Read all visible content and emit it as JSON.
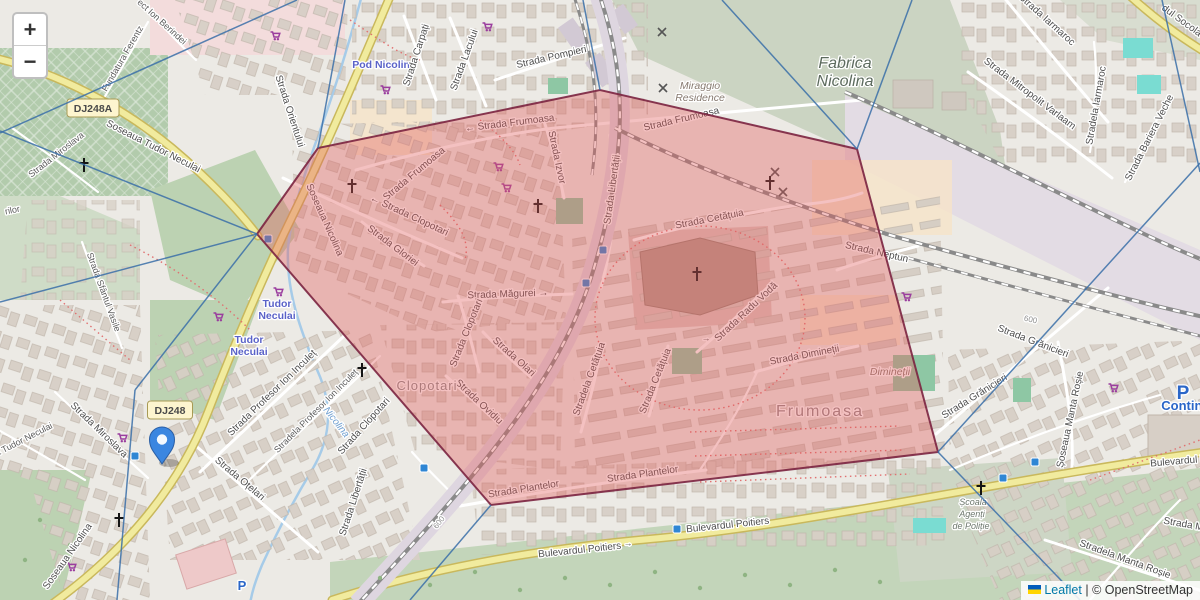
{
  "controls": {
    "zoom_in_label": "+",
    "zoom_out_label": "−"
  },
  "attribution": {
    "flag_icon": "ukraine-flag",
    "leaflet_text": "Leaflet",
    "separator": " | ",
    "copyright_text": "© OpenStreetMap"
  },
  "overlay": {
    "selected_region": {
      "fill": "#e35d5d",
      "fill_opacity": 0.38,
      "stroke": "#7b2440",
      "points": [
        [
          257,
          234
        ],
        [
          318,
          148
        ],
        [
          600,
          90
        ],
        [
          857,
          149
        ],
        [
          938,
          452
        ],
        [
          491,
          505
        ]
      ]
    },
    "boundary_lines": {
      "color": "#3a6ea8",
      "segments": [
        [
          297,
          0,
          0,
          133
        ],
        [
          0,
          131,
          257,
          234
        ],
        [
          257,
          234,
          0,
          302
        ],
        [
          257,
          234,
          135,
          390
        ],
        [
          135,
          390,
          117,
          600
        ],
        [
          318,
          148,
          345,
          0
        ],
        [
          600,
          90,
          583,
          0
        ],
        [
          857,
          149,
          722,
          0
        ],
        [
          857,
          149,
          912,
          0
        ],
        [
          938,
          452,
          1200,
          163
        ],
        [
          1162,
          0,
          1200,
          172
        ],
        [
          938,
          452,
          1080,
          600
        ],
        [
          491,
          505,
          410,
          600
        ]
      ]
    }
  },
  "marker": {
    "color": "#3b86e0",
    "x": 162,
    "y": 464
  },
  "map": {
    "shields": [
      {
        "t": "DJ248A",
        "x": 93,
        "y": 108
      },
      {
        "t": "DJ248",
        "x": 170,
        "y": 410
      }
    ],
    "labels": [
      {
        "t": "Soseaua Tudor Neculai",
        "x": 152,
        "y": 149,
        "r": 27
      },
      {
        "t": "Fundatura Ferentz",
        "x": 125,
        "y": 60,
        "r": -60,
        "cls": "st-sm"
      },
      {
        "t": "ect Ion Berindei",
        "x": 160,
        "y": 24,
        "r": 42,
        "cls": "st-sm"
      },
      {
        "t": "Strada Miroslava",
        "x": 58,
        "y": 157,
        "r": -38,
        "cls": "st-sm"
      },
      {
        "t": "Strada Miroslava",
        "x": 97,
        "y": 432,
        "r": 44
      },
      {
        "t": "Strada Sfântul Vasile",
        "x": 101,
        "y": 293,
        "r": 70,
        "cls": "st-sm"
      },
      {
        "t": "rilor",
        "x": 13,
        "y": 213,
        "r": -12,
        "cls": "st-sm"
      },
      {
        "t": "a Tudor Neculai",
        "x": 25,
        "y": 442,
        "r": -27,
        "cls": "st-sm"
      },
      {
        "t": "Strada Orientului",
        "x": 287,
        "y": 112,
        "r": 72
      },
      {
        "t": "Soseaua Nicolina",
        "x": 322,
        "y": 221,
        "r": 66
      },
      {
        "t": "Soseaua Nicolina",
        "x": 70,
        "y": 558,
        "r": -55
      },
      {
        "t": "Pod Nicolina",
        "x": 384,
        "y": 68,
        "r": 0,
        "cls": "transit",
        "n": "transit-stop-label"
      },
      {
        "t": "Strada Carpați",
        "x": 419,
        "y": 56,
        "r": -72
      },
      {
        "t": "Strada Lacului",
        "x": 467,
        "y": 61,
        "r": -70
      },
      {
        "t": "Strada Pompieri",
        "x": 552,
        "y": 60,
        "r": -13
      },
      {
        "t": "Strada Frumoasa",
        "x": 416,
        "y": 176,
        "r": -40
      },
      {
        "t": "← Strada Frumoasa",
        "x": 510,
        "y": 126,
        "r": -7
      },
      {
        "t": "Strada Frumoasa",
        "x": 682,
        "y": 122,
        "r": -13
      },
      {
        "t": "Strada Izvor",
        "x": 554,
        "y": 158,
        "r": 78
      },
      {
        "t": "Strada Libertății",
        "x": 615,
        "y": 190,
        "r": -82
      },
      {
        "t": "Strada Cetățuia",
        "x": 710,
        "y": 222,
        "r": -11
      },
      {
        "t": "← Strada Clopotari",
        "x": 408,
        "y": 218,
        "r": 25
      },
      {
        "t": "Strada Gloriei",
        "x": 391,
        "y": 248,
        "r": 37
      },
      {
        "t": "Strada Măgurei →",
        "x": 508,
        "y": 297,
        "r": -2
      },
      {
        "t": "Strada Clopotari",
        "x": 469,
        "y": 334,
        "r": -68
      },
      {
        "t": "Strada Olari",
        "x": 512,
        "y": 359,
        "r": 42
      },
      {
        "t": "Strada Ovidiu",
        "x": 477,
        "y": 404,
        "r": 43
      },
      {
        "t": "Clopotari",
        "x": 427,
        "y": 390,
        "r": 0,
        "cls": "area",
        "n": "neighbourhood-label"
      },
      {
        "t": "Stradela Cetățuia",
        "x": 592,
        "y": 380,
        "r": -70
      },
      {
        "t": "Strada Cetățuia",
        "x": 658,
        "y": 382,
        "r": -68
      },
      {
        "t": "Strada Plantelor",
        "x": 524,
        "y": 492,
        "r": -9
      },
      {
        "t": "Strada Plantelor",
        "x": 643,
        "y": 477,
        "r": -8
      },
      {
        "t": "→",
        "x": 706,
        "y": 341,
        "r": 0,
        "cls": "st-sm"
      },
      {
        "t": "Strada Radu Vodă",
        "x": 748,
        "y": 314,
        "r": -43
      },
      {
        "t": "Strada Dimineții",
        "x": 805,
        "y": 358,
        "r": -11
      },
      {
        "t": "Dimineții",
        "x": 890,
        "y": 375,
        "r": 0,
        "cls": "area-it",
        "n": "locality-label"
      },
      {
        "t": "Frumoasa",
        "x": 820,
        "y": 416,
        "r": 0,
        "cls": "area-big",
        "n": "neighbourhood-label"
      },
      {
        "t": "Strada Neptun",
        "x": 876,
        "y": 255,
        "r": 13
      },
      {
        "t": "Strada Grănicieri",
        "x": 1032,
        "y": 344,
        "r": 21
      },
      {
        "t": "Strada Grănicieri",
        "x": 976,
        "y": 399,
        "r": -32
      },
      {
        "t": "Șoseaua Manta Roșie",
        "x": 1073,
        "y": 420,
        "r": -78
      },
      {
        "t": "Stradela Manta Roșie",
        "x": 1124,
        "y": 562,
        "r": 20
      },
      {
        "t": "Strada M",
        "x": 1183,
        "y": 527,
        "r": 10
      },
      {
        "t": "Școala",
        "x": 973,
        "y": 505,
        "r": 0,
        "cls": "school",
        "n": "school-label"
      },
      {
        "t": "Agenți",
        "x": 972,
        "y": 517,
        "r": 0,
        "cls": "school",
        "n": "school-label"
      },
      {
        "t": "de Poliție",
        "x": 971,
        "y": 529,
        "r": 0,
        "cls": "school",
        "n": "school-label"
      },
      {
        "t": "Bulevardul Poitiers",
        "x": 580,
        "y": 553,
        "r": -6
      },
      {
        "t": "Bulevardul Poitiers",
        "x": 728,
        "y": 528,
        "r": -6
      },
      {
        "t": "Bulevardul Poitiers",
        "x": 1192,
        "y": 463,
        "r": -5
      },
      {
        "t": "→",
        "x": 628,
        "y": 546,
        "r": 0,
        "cls": "st-sm"
      },
      {
        "t": "Strada Iarmaroc",
        "x": 1045,
        "y": 22,
        "r": 42
      },
      {
        "t": "Stradela Iarmaroc",
        "x": 1099,
        "y": 106,
        "r": -80
      },
      {
        "t": "Strada Mitropolit Varlaam",
        "x": 1028,
        "y": 96,
        "r": 37
      },
      {
        "t": "Strada Bariera Veche",
        "x": 1152,
        "y": 139,
        "r": -63
      },
      {
        "t": "dul Socola",
        "x": 1180,
        "y": 23,
        "r": 36
      },
      {
        "t": "Strada Profesor Ion Inculeț",
        "x": 274,
        "y": 395,
        "r": -44
      },
      {
        "t": "Stradela Profesor Ion Inculeț",
        "x": 318,
        "y": 413,
        "r": -45,
        "cls": "st-sm"
      },
      {
        "t": "Strada Oțelari",
        "x": 238,
        "y": 481,
        "r": 40
      },
      {
        "t": "Strada Clopotari",
        "x": 366,
        "y": 428,
        "r": -48
      },
      {
        "t": "Strada Libertății",
        "x": 356,
        "y": 503,
        "r": -72
      },
      {
        "t": "Tudor",
        "x": 277,
        "y": 307,
        "r": 0,
        "cls": "transit",
        "n": "transit-stop-label"
      },
      {
        "t": "Neculai",
        "x": 277,
        "y": 319,
        "r": 0,
        "cls": "transit",
        "n": "transit-stop-label"
      },
      {
        "t": "Tudor",
        "x": 249,
        "y": 343,
        "r": 0,
        "cls": "transit",
        "n": "transit-stop-label"
      },
      {
        "t": "Neculai",
        "x": 249,
        "y": 355,
        "r": 0,
        "cls": "transit",
        "n": "transit-stop-label"
      },
      {
        "t": "Nicolina",
        "x": 334,
        "y": 424,
        "r": 52,
        "cls": "water",
        "n": "river-label"
      },
      {
        "t": "600",
        "x": 441,
        "y": 524,
        "r": -52,
        "cls": "rail",
        "n": "railway-milestone-label"
      },
      {
        "t": "600",
        "x": 1030,
        "y": 322,
        "r": 13,
        "cls": "rail",
        "n": "railway-milestone-label"
      },
      {
        "t": "Miraggio",
        "x": 700,
        "y": 89,
        "r": 0,
        "cls": "area-it",
        "n": "residence-label"
      },
      {
        "t": "Residence",
        "x": 700,
        "y": 101,
        "r": 0,
        "cls": "area-it",
        "n": "residence-label"
      },
      {
        "t": "Fabrica",
        "x": 845,
        "y": 68,
        "r": 0,
        "cls": "industrial",
        "n": "industrial-area-label"
      },
      {
        "t": "Nicolina",
        "x": 845,
        "y": 86,
        "r": 0,
        "cls": "industrial",
        "n": "industrial-area-label"
      },
      {
        "t": "Continental",
        "x": 1197,
        "y": 410,
        "r": 0,
        "cls": "parking-sm",
        "n": "parking-label"
      },
      {
        "t": "P",
        "x": 1183,
        "y": 399,
        "r": 0,
        "cls": "parking-big",
        "n": "parking-icon"
      },
      {
        "t": "P",
        "x": 242,
        "y": 590,
        "r": 0,
        "cls": "parking-sm",
        "n": "parking-icon"
      }
    ],
    "icons": [
      {
        "n": "church-cross-icon",
        "x": 84,
        "y": 166
      },
      {
        "n": "church-cross-icon",
        "x": 352,
        "y": 187
      },
      {
        "n": "church-cross-icon",
        "x": 538,
        "y": 207
      },
      {
        "n": "church-cross-icon",
        "x": 697,
        "y": 275
      },
      {
        "n": "church-cross-icon",
        "x": 770,
        "y": 184
      },
      {
        "n": "church-cross-icon",
        "x": 362,
        "y": 371
      },
      {
        "n": "church-cross-icon",
        "x": 119,
        "y": 521
      },
      {
        "n": "church-cross-icon",
        "x": 981,
        "y": 489
      },
      {
        "n": "level-crossing-icon",
        "x": 662,
        "y": 32
      },
      {
        "n": "level-crossing-icon",
        "x": 663,
        "y": 88
      },
      {
        "n": "level-crossing-icon",
        "x": 775,
        "y": 172
      },
      {
        "n": "level-crossing-icon",
        "x": 783,
        "y": 192
      },
      {
        "n": "shopping-cart-icon",
        "x": 275,
        "y": 36
      },
      {
        "n": "shopping-cart-icon",
        "x": 487,
        "y": 27
      },
      {
        "n": "shopping-cart-icon",
        "x": 385,
        "y": 90
      },
      {
        "n": "shopping-cart-icon",
        "x": 498,
        "y": 167
      },
      {
        "n": "shopping-cart-icon",
        "x": 506,
        "y": 188
      },
      {
        "n": "shopping-cart-icon",
        "x": 278,
        "y": 292
      },
      {
        "n": "shopping-cart-icon",
        "x": 218,
        "y": 317
      },
      {
        "n": "shopping-cart-icon",
        "x": 122,
        "y": 438
      },
      {
        "n": "shopping-cart-icon",
        "x": 71,
        "y": 567
      },
      {
        "n": "shopping-cart-icon",
        "x": 1113,
        "y": 388
      },
      {
        "n": "shopping-cart-icon",
        "x": 906,
        "y": 297
      },
      {
        "n": "bus-stop-icon",
        "x": 268,
        "y": 239
      },
      {
        "n": "bus-stop-icon",
        "x": 603,
        "y": 250
      },
      {
        "n": "bus-stop-icon",
        "x": 586,
        "y": 283
      },
      {
        "n": "bus-stop-icon",
        "x": 424,
        "y": 468
      },
      {
        "n": "bus-stop-icon",
        "x": 677,
        "y": 529
      },
      {
        "n": "bus-stop-icon",
        "x": 1003,
        "y": 478
      },
      {
        "n": "bus-stop-icon",
        "x": 1035,
        "y": 462
      },
      {
        "n": "bus-stop-icon",
        "x": 135,
        "y": 456
      }
    ]
  }
}
